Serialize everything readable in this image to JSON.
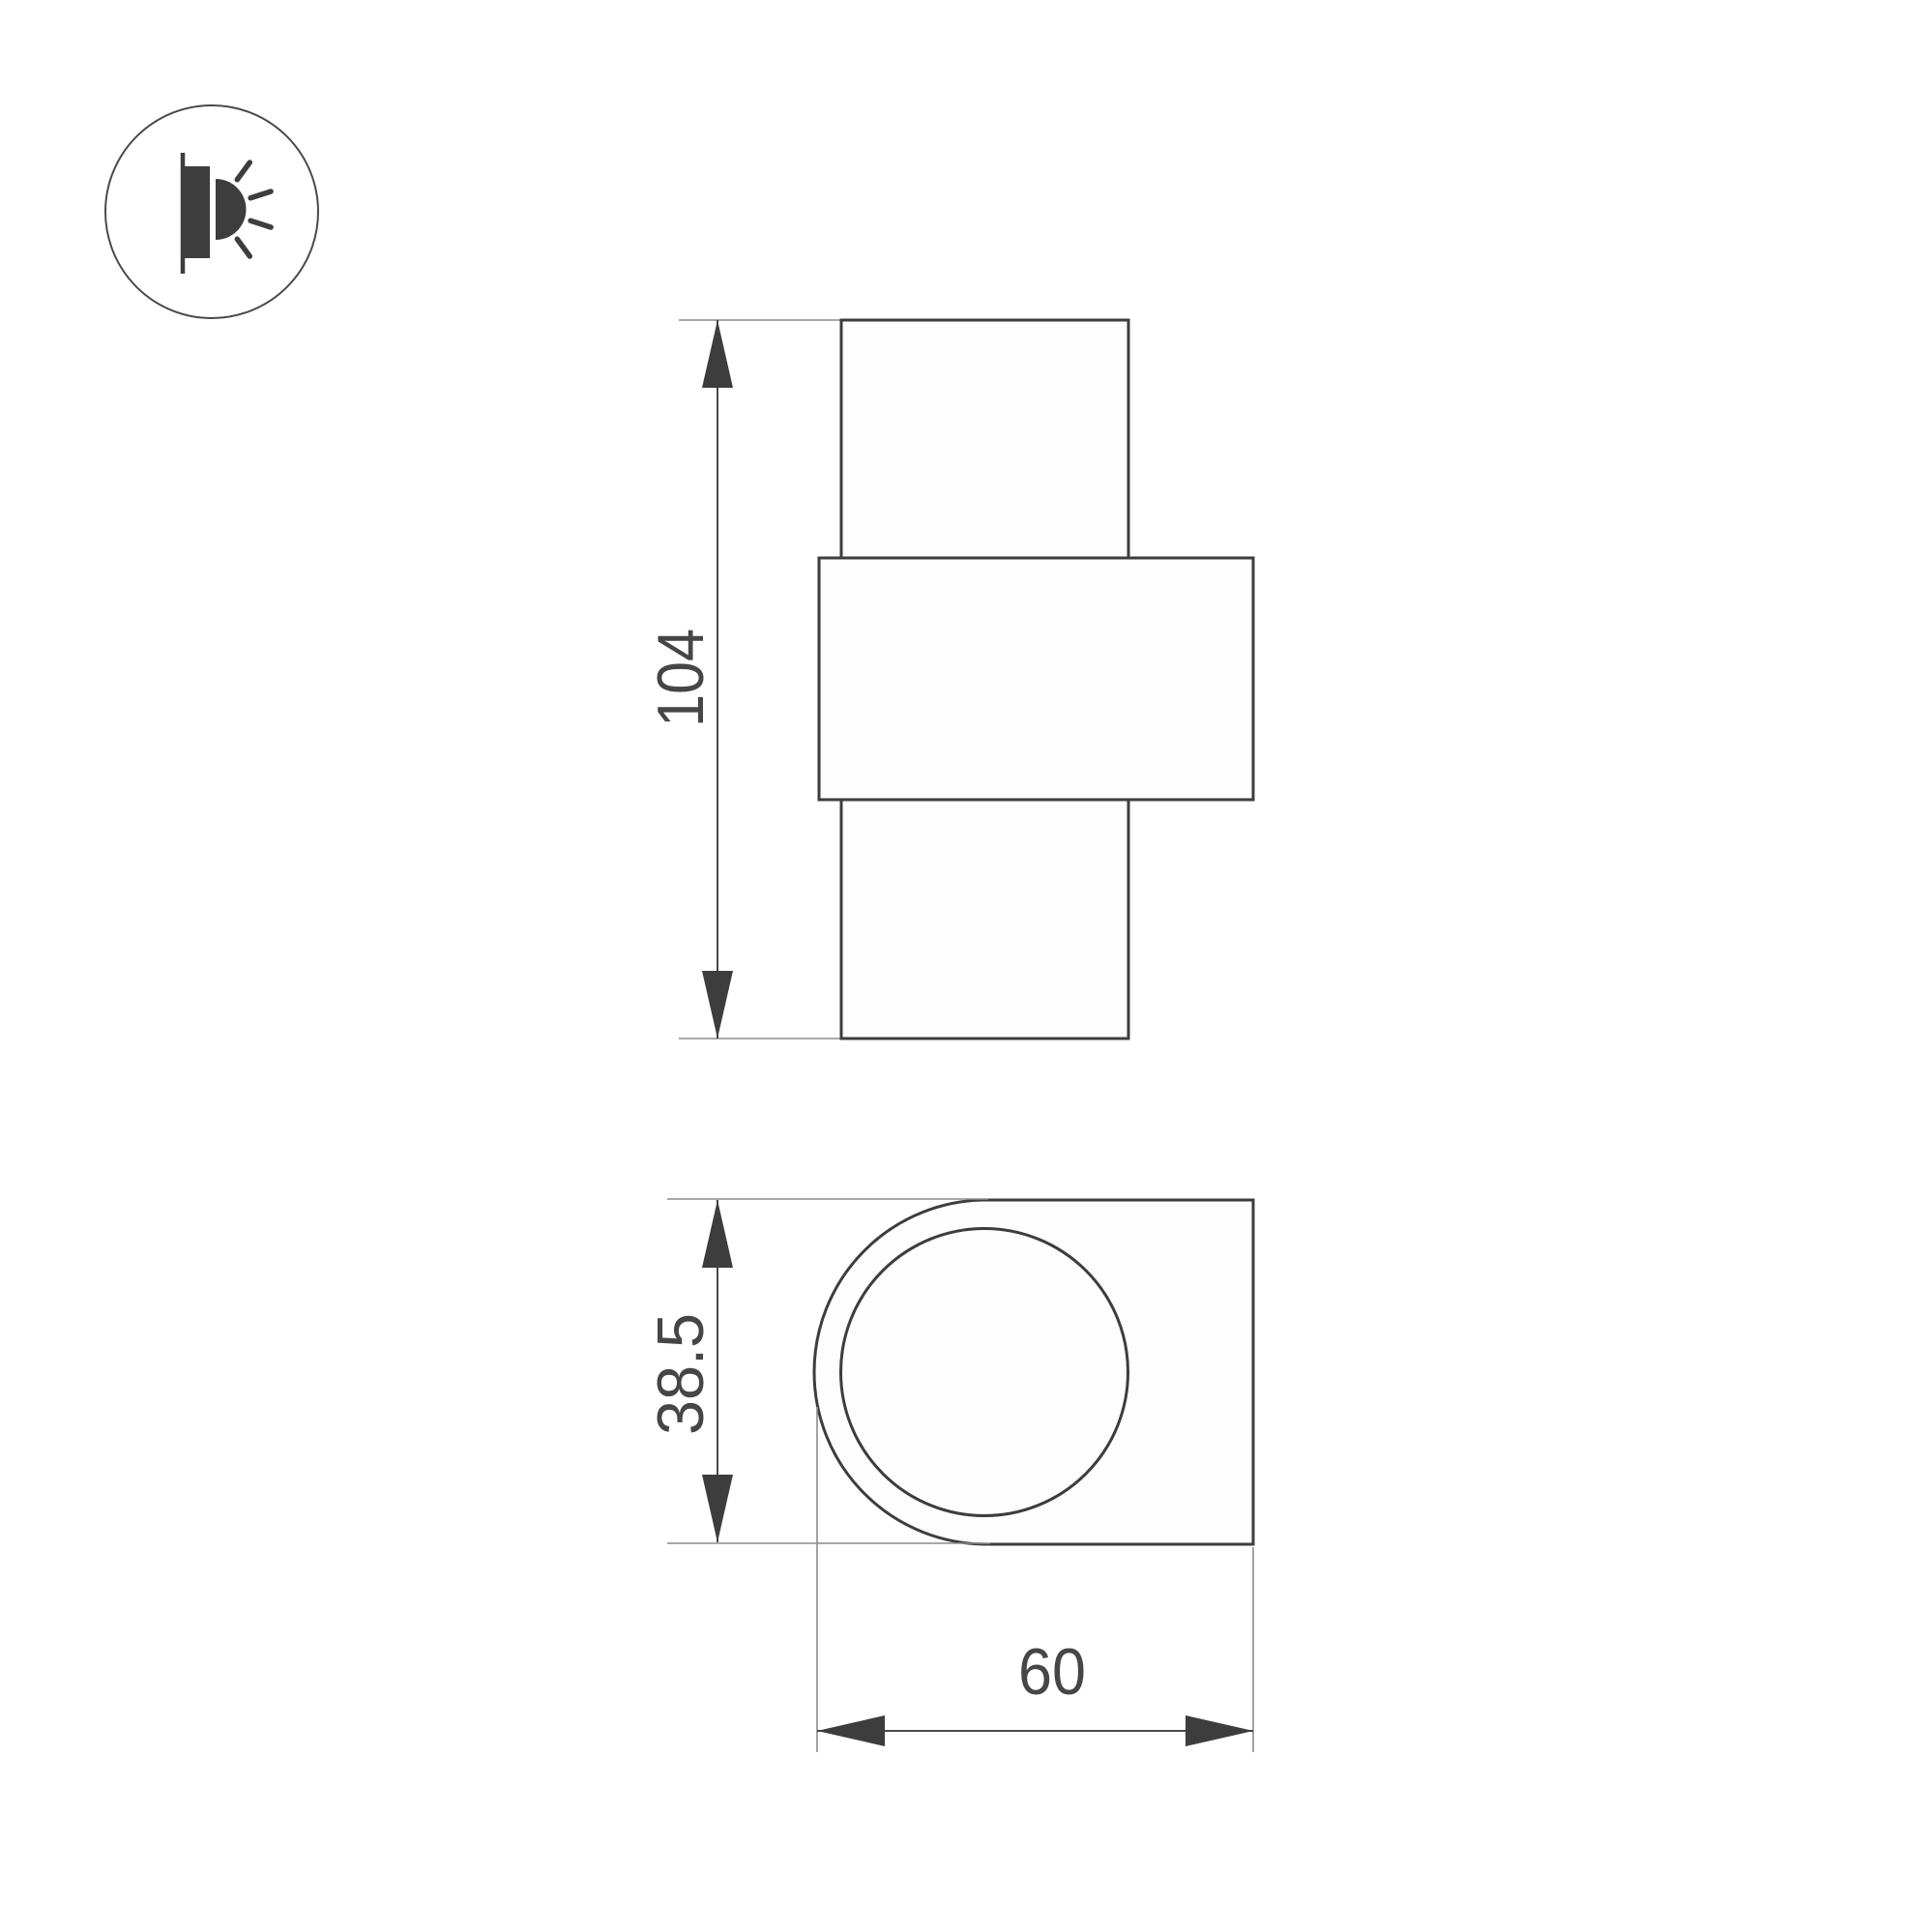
{
  "document": {
    "type": "technical-drawing",
    "background": "#ffffff"
  },
  "colors": {
    "outline": "#3d3d3d",
    "dimension_line": "#4a4a4a",
    "extension_line": "#8c8c8c",
    "arrow": "#3d3d3d",
    "text": "#464646",
    "shape_fill": "#fdfdfd",
    "icon": "#3d3d3d"
  },
  "icon": {
    "label": "wall-luminaire-glow-icon"
  },
  "front_view": {
    "dimension_height": {
      "label": "104"
    }
  },
  "side_view": {
    "dimension_depth": {
      "label": "38.5"
    },
    "dimension_width": {
      "label": "60"
    }
  }
}
